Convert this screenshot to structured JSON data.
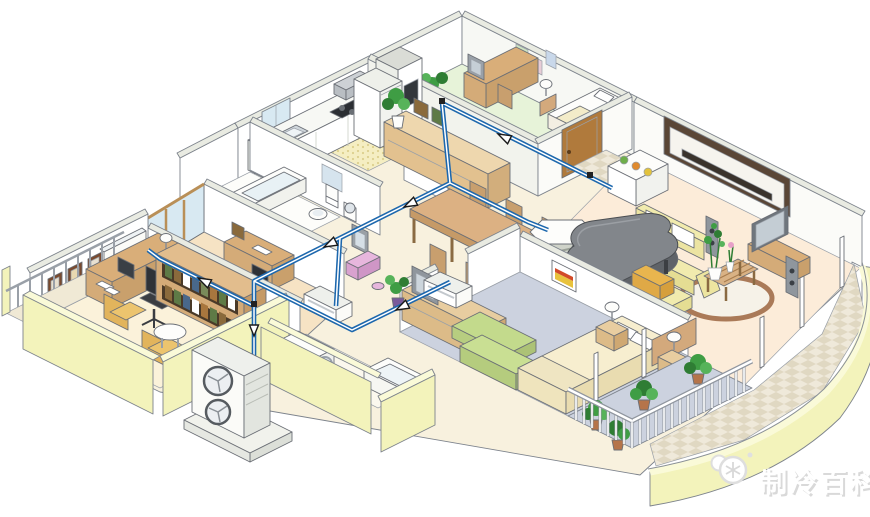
{
  "watermark": {
    "text": "制冷百科",
    "logo": "snowflake-cloud-icon"
  },
  "scene": {
    "kind": "isometric-cutaway-home-hvac",
    "rooms": [
      "kitchen",
      "dining-room",
      "tatami-study-room",
      "entry-hall",
      "living-room",
      "bedroom",
      "kids-study-room",
      "home-office",
      "bathroom",
      "washroom",
      "west-balcony",
      "bedroom-balcony",
      "living-balcony"
    ],
    "equipment": {
      "outdoor_unit": "twin-fan-outdoor-unit-on-pad",
      "indoor_units": [
        "wall-mounted-unit-office",
        "floor-console-kids-room",
        "floor-console-bedroom",
        "ceiling-cassette-living-dining"
      ],
      "piping": "refrigerant-lines-with-flow-arrows"
    }
  },
  "palette": {
    "pipe_blue": "#1c67ad",
    "outer_wall": "#f3f3bb",
    "outer_wall_top": "#fafad8",
    "wall_face": "#ffffff",
    "wall_top": "#e9ebe2",
    "floor_base": "#f8f1de",
    "floor_tatami": "#e7f3d9",
    "floor_living": "#fcecd9",
    "floor_carpet": "#ccd2df",
    "floor_kids": "#f6e3c4",
    "floor_office": "#fbf2da",
    "floor_tile": "#efe9da",
    "tile_check": "#e0d8c2",
    "wood": "#d9ae79",
    "wood_dark": "#b98a55",
    "wood_light": "#ecd3a8",
    "sofa_yellow": "#f1ebae",
    "sofa_green": "#c9df93",
    "piano_gray": "#82868b",
    "plant_green": "#3f9d44",
    "pot_terracotta": "#b5744a",
    "unit_white": "#fbfbf8",
    "watermark_gray": "#d9d9d9"
  }
}
